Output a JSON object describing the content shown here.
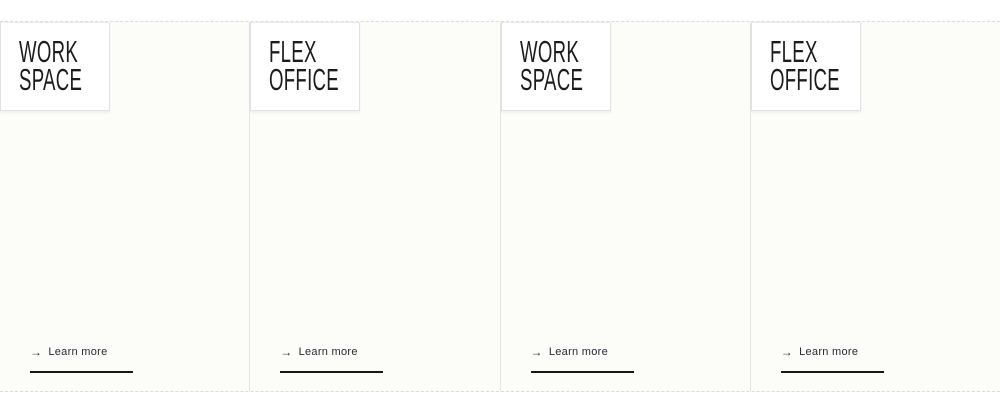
{
  "icons": {
    "arrow_right": "→"
  },
  "colors": {
    "section_background": "#fcfcf8",
    "section_border": "#dcdcd6",
    "column_divider": "#e4e4e0",
    "title_box_background": "#ffffff",
    "title_box_border": "#e2e2e4",
    "title_text": "#1c1c1a",
    "link_text": "#262b37",
    "underline": "#17171b"
  },
  "cards": [
    {
      "title_line1": "WORK",
      "title_line2": "SPACE",
      "link_label": "Learn more"
    },
    {
      "title_line1": "FLEX",
      "title_line2": "OFFICE",
      "link_label": "Learn more"
    },
    {
      "title_line1": "WORK",
      "title_line2": "SPACE",
      "link_label": "Learn more"
    },
    {
      "title_line1": "FLEX",
      "title_line2": "OFFICE",
      "link_label": "Learn more"
    }
  ]
}
